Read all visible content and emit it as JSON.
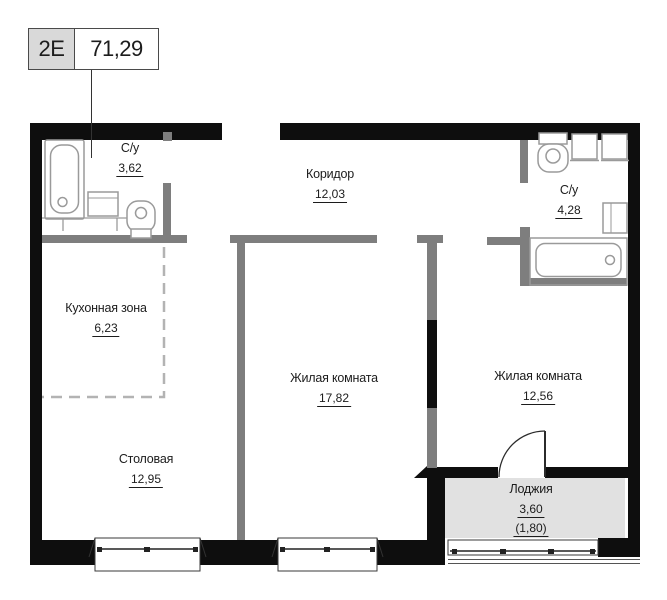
{
  "unit": {
    "type_code": "2E",
    "total_area": "71,29"
  },
  "rooms": [
    {
      "id": "bathroom-1",
      "name": "С/у",
      "area": "3,62"
    },
    {
      "id": "corridor",
      "name": "Коридор",
      "area": "12,03"
    },
    {
      "id": "bathroom-2",
      "name": "С/у",
      "area": "4,28"
    },
    {
      "id": "kitchen",
      "name": "Кухонная зона",
      "area": "6,23"
    },
    {
      "id": "living-1",
      "name": "Жилая комната",
      "area": "17,82"
    },
    {
      "id": "living-2",
      "name": "Жилая комната",
      "area": "12,56"
    },
    {
      "id": "dining",
      "name": "Столовая",
      "area": "12,95"
    },
    {
      "id": "loggia",
      "name": "Лоджия",
      "area": "3,60",
      "area_secondary": "(1,80)"
    }
  ],
  "colors": {
    "wall-black": "#0e0e0e",
    "wall-gray": "#7e7e7e",
    "loggia-fill": "#e1e1e1",
    "fixture-stroke": "#9a9a9a",
    "dashed-line": "#b3b3b3",
    "text": "#1c1c1c",
    "label-box-fill": "#d9d9d9",
    "label-box-border": "#4a4a4a"
  }
}
